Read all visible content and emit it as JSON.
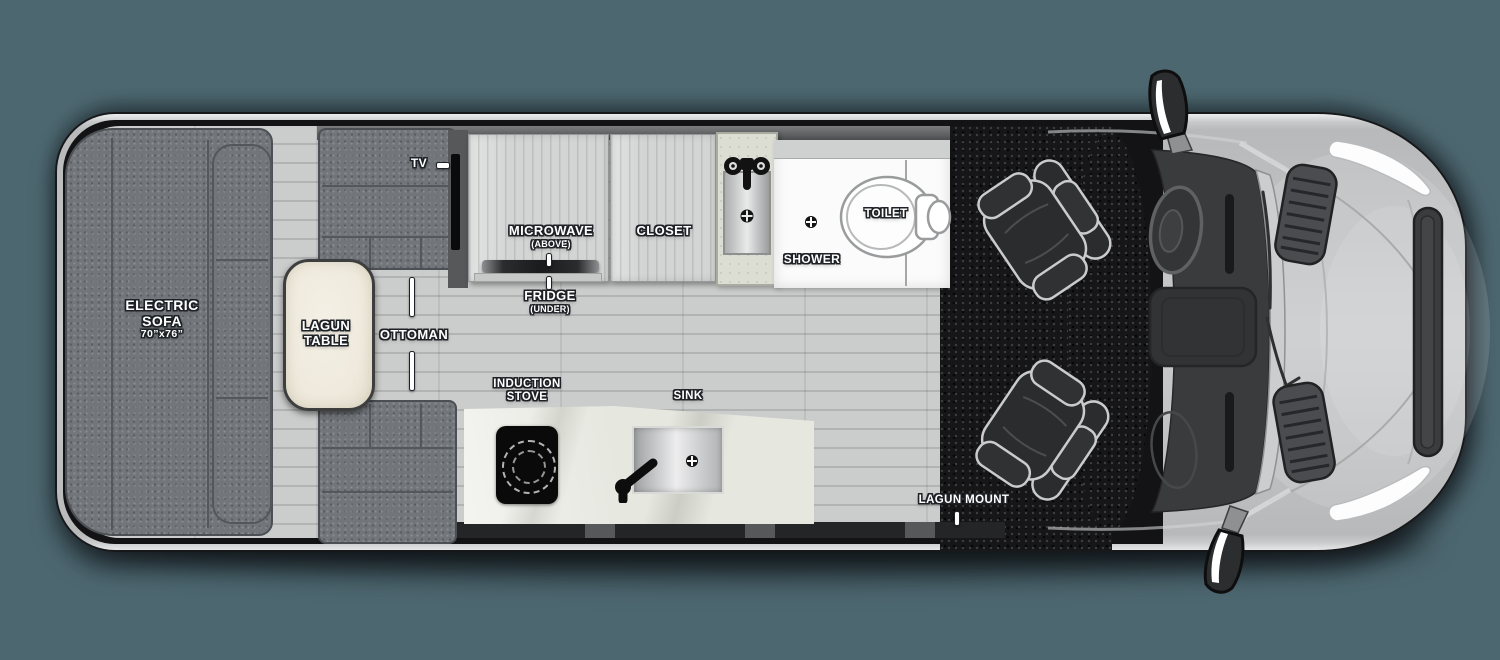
{
  "floorplan": {
    "view": "camper van top-down floor plan",
    "living_area": {
      "electric_sofa": {
        "name_line1": "ELECTRIC",
        "name_line2": "SOFA",
        "dimensions": "70”x76”"
      },
      "lagun_table": {
        "name_line1": "LAGUN",
        "name_line2": "TABLE"
      },
      "ottoman": {
        "name": "OTTOMAN"
      },
      "tv": {
        "name": "TV"
      }
    },
    "kitchen": {
      "microwave": {
        "name": "MICROWAVE",
        "position_note": "(ABOVE)"
      },
      "fridge": {
        "name": "FRIDGE",
        "position_note": "(UNDER)"
      },
      "closet": {
        "name": "CLOSET"
      },
      "induction_stove": {
        "name_line1": "INDUCTION",
        "name_line2": "STOVE"
      },
      "sink": {
        "name": "SINK"
      }
    },
    "bathroom": {
      "shower": {
        "name": "SHOWER"
      },
      "toilet": {
        "name": "TOILET"
      }
    },
    "cab": {
      "lagun_mount": {
        "name": "LAGUN MOUNT"
      }
    },
    "colors": {
      "page_background": "#4d6770",
      "body_silver": "#c2c4c6",
      "upholstery_gray": "#72767b",
      "floor_wood": "#c6c8c7",
      "table_cream": "#efeadd",
      "cab_floor_black": "#161618",
      "bath_white": "#fbfbfb",
      "label_text": "#ffffff"
    }
  }
}
